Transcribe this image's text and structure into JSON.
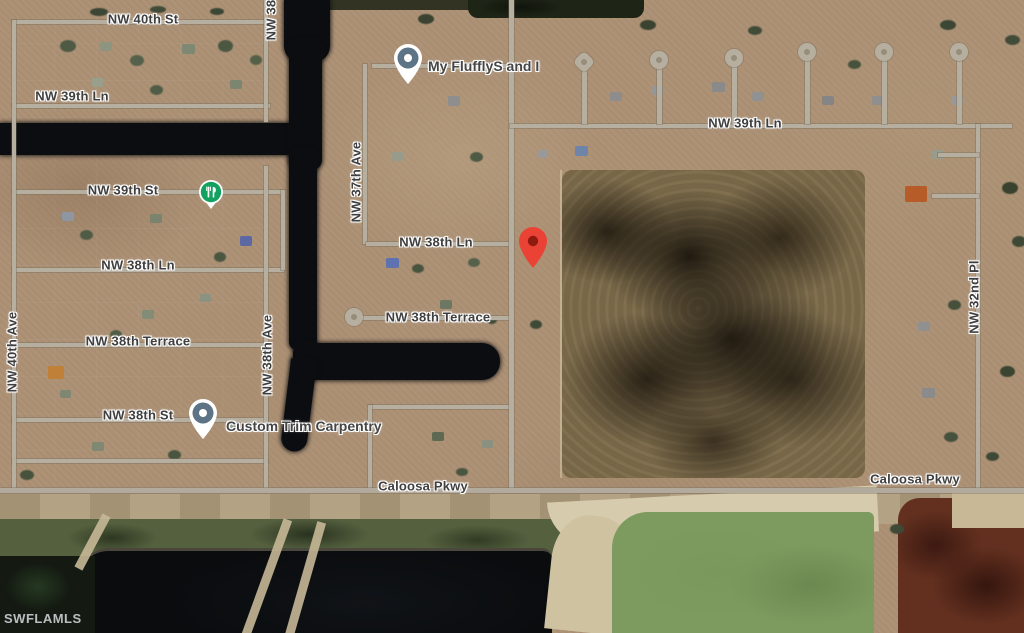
{
  "map": {
    "watermark": "SWFLAMLS",
    "streets": {
      "nw_40th_st": "NW 40th St",
      "nw_39th_ln_left": "NW 39th Ln",
      "nw_39th_ln_right": "NW 39th Ln",
      "nw_39th_st": "NW 39th St",
      "nw_38th_ln_left": "NW 38th Ln",
      "nw_38th_ln_mid": "NW 38th Ln",
      "nw_38th_terrace_left": "NW 38th Terrace",
      "nw_38th_terrace_mid": "NW 38th Terrace",
      "nw_38th_st": "NW 38th St",
      "nw_40th_ave": "NW 40th Ave",
      "nw_38th_ave": "NW 38th Ave",
      "nw_38_partial": "NW 38",
      "nw_37th_ave": "NW 37th Ave",
      "nw_32nd_pl": "NW 32nd Pl",
      "caloosa_pkwy_mid": "Caloosa Pkwy",
      "caloosa_pkwy_right": "Caloosa Pkwy"
    },
    "markers": {
      "fluffly_label": "My FlufflyS and I",
      "custom_trim_label": "Custom Trim Carpentry"
    },
    "colors": {
      "red_pin": "#EA4335",
      "red_pin_dot": "#8F1B10",
      "business_pin_circle": "#5D7486",
      "poi_green": "#12A15F",
      "road": "#B6AE9F",
      "water": "#0C0D10",
      "field_green": "#7D9A5F",
      "pit_brown": "#63301F",
      "label_text": "#3F3F3F"
    }
  }
}
